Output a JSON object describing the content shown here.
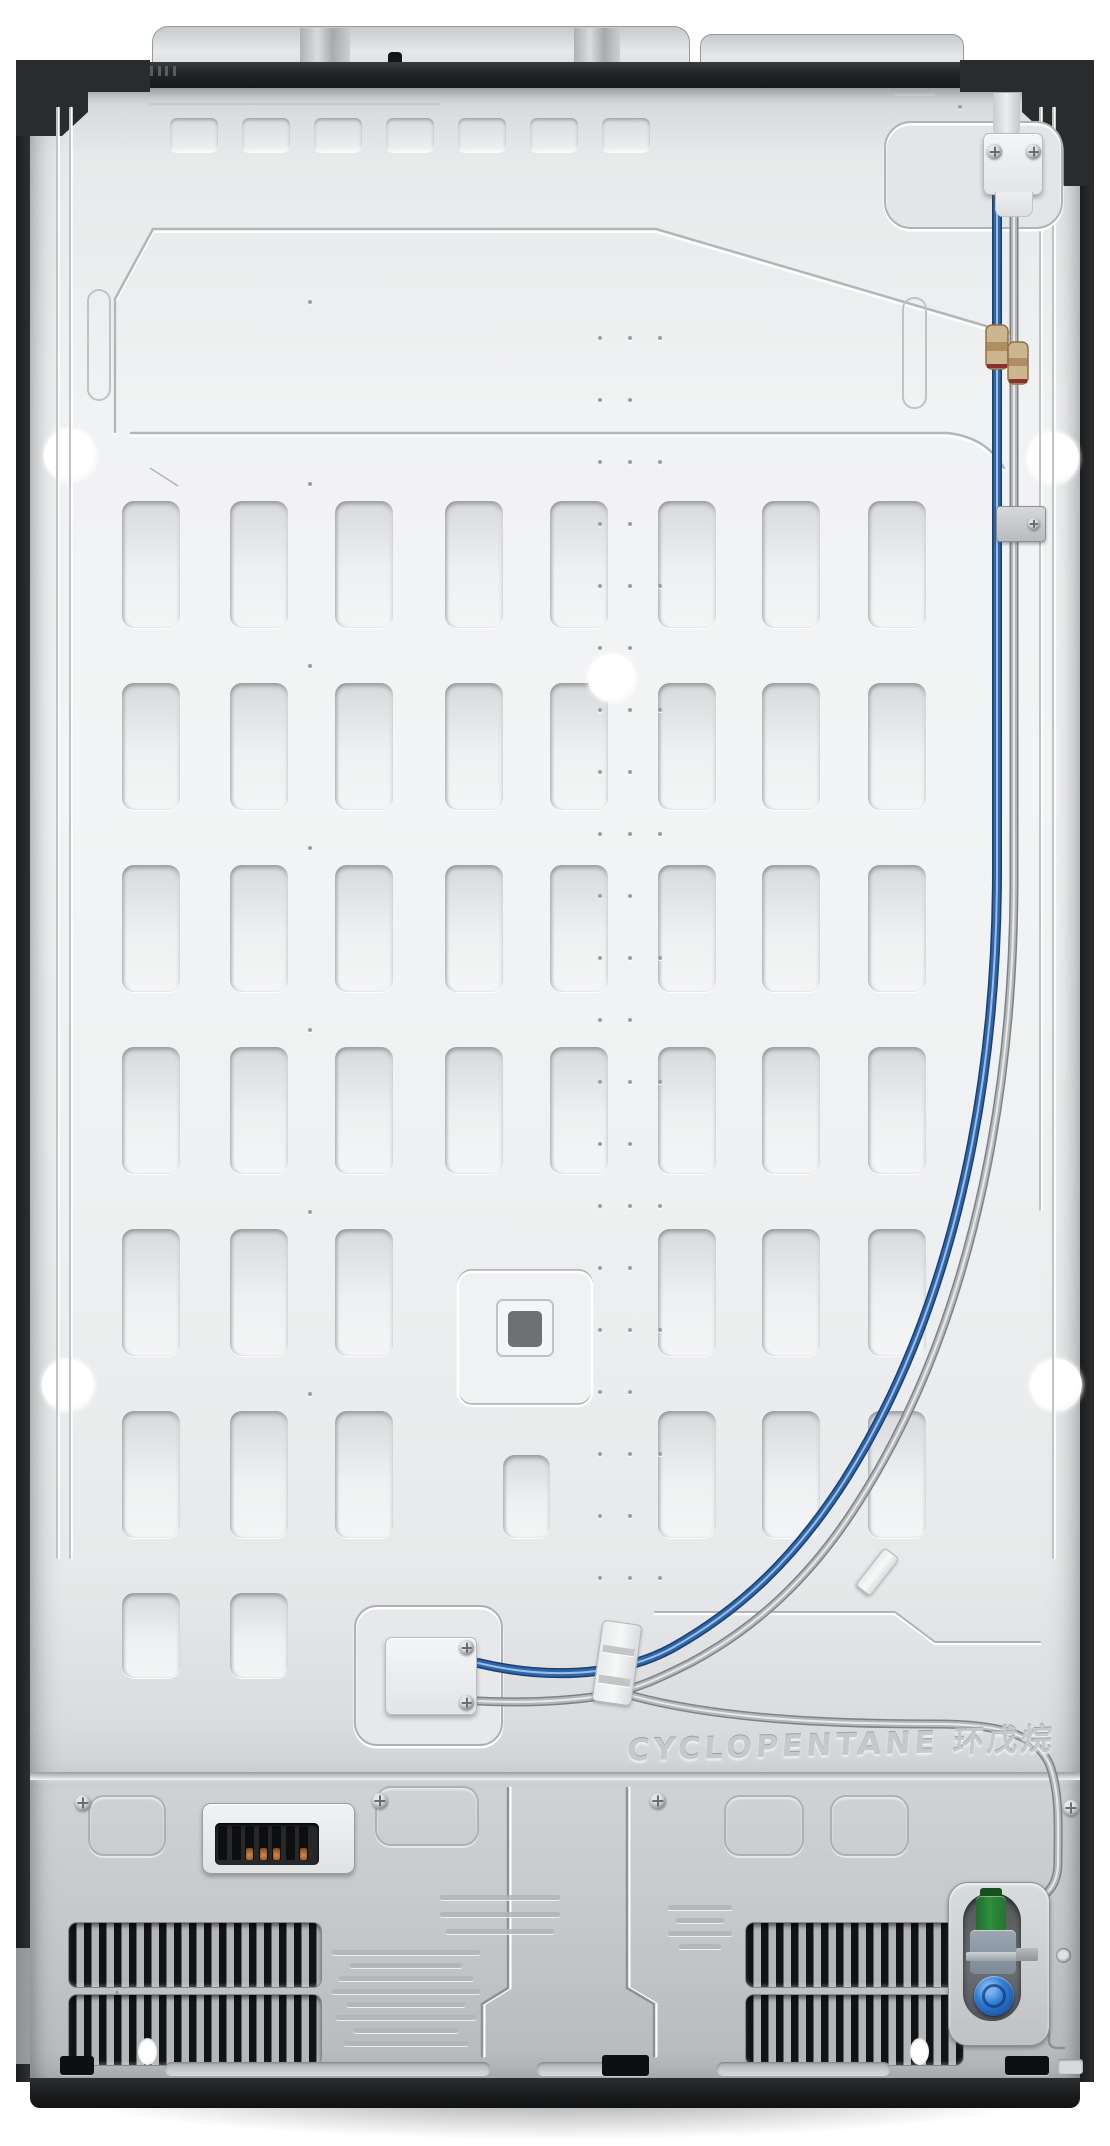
{
  "image": {
    "subject": "refrigerator back panel photo",
    "view": "rear"
  },
  "embossed_text": {
    "refrigerant": "CYCLOPENTANE 环戊烷"
  },
  "labels": {
    "left_warning_label": {
      "legible": false,
      "lines": 8
    },
    "upper_faint_marks": {
      "legible": false,
      "lines": 3
    },
    "right_warning_label": {
      "legible": false,
      "lines": 4
    }
  },
  "colors": {
    "tube_blue_main": "#2e66ab",
    "tube_blue_edge": "#1c3f6e",
    "tube_blue_highlight": "#9dbfe6",
    "tube_grey_main": "#b4b7ba",
    "tube_grey_edge": "#7f8285",
    "tube_grey_highlight": "#e6e8ea",
    "coupler_brass": "#cbb68f",
    "coupler_brass_dark": "#96703f",
    "valve_green": "#2e8f3c",
    "coil_blue": "#2f7fd6",
    "terminal_orange": "#d98a43",
    "panel_silver": "#eef0f1",
    "frame_dark": "#222325"
  },
  "counts": {
    "top_small_slots": 7,
    "panel_slot_columns": 8,
    "panel_slot_rows": 6,
    "white_holes": 5,
    "inline_couplers": 2,
    "terminal_slots": 7,
    "vent_bands_left": 2,
    "vent_bands_right": 2,
    "corner_screws": 2,
    "top_connector_screws": 2,
    "junction_connector_screws": 2
  }
}
